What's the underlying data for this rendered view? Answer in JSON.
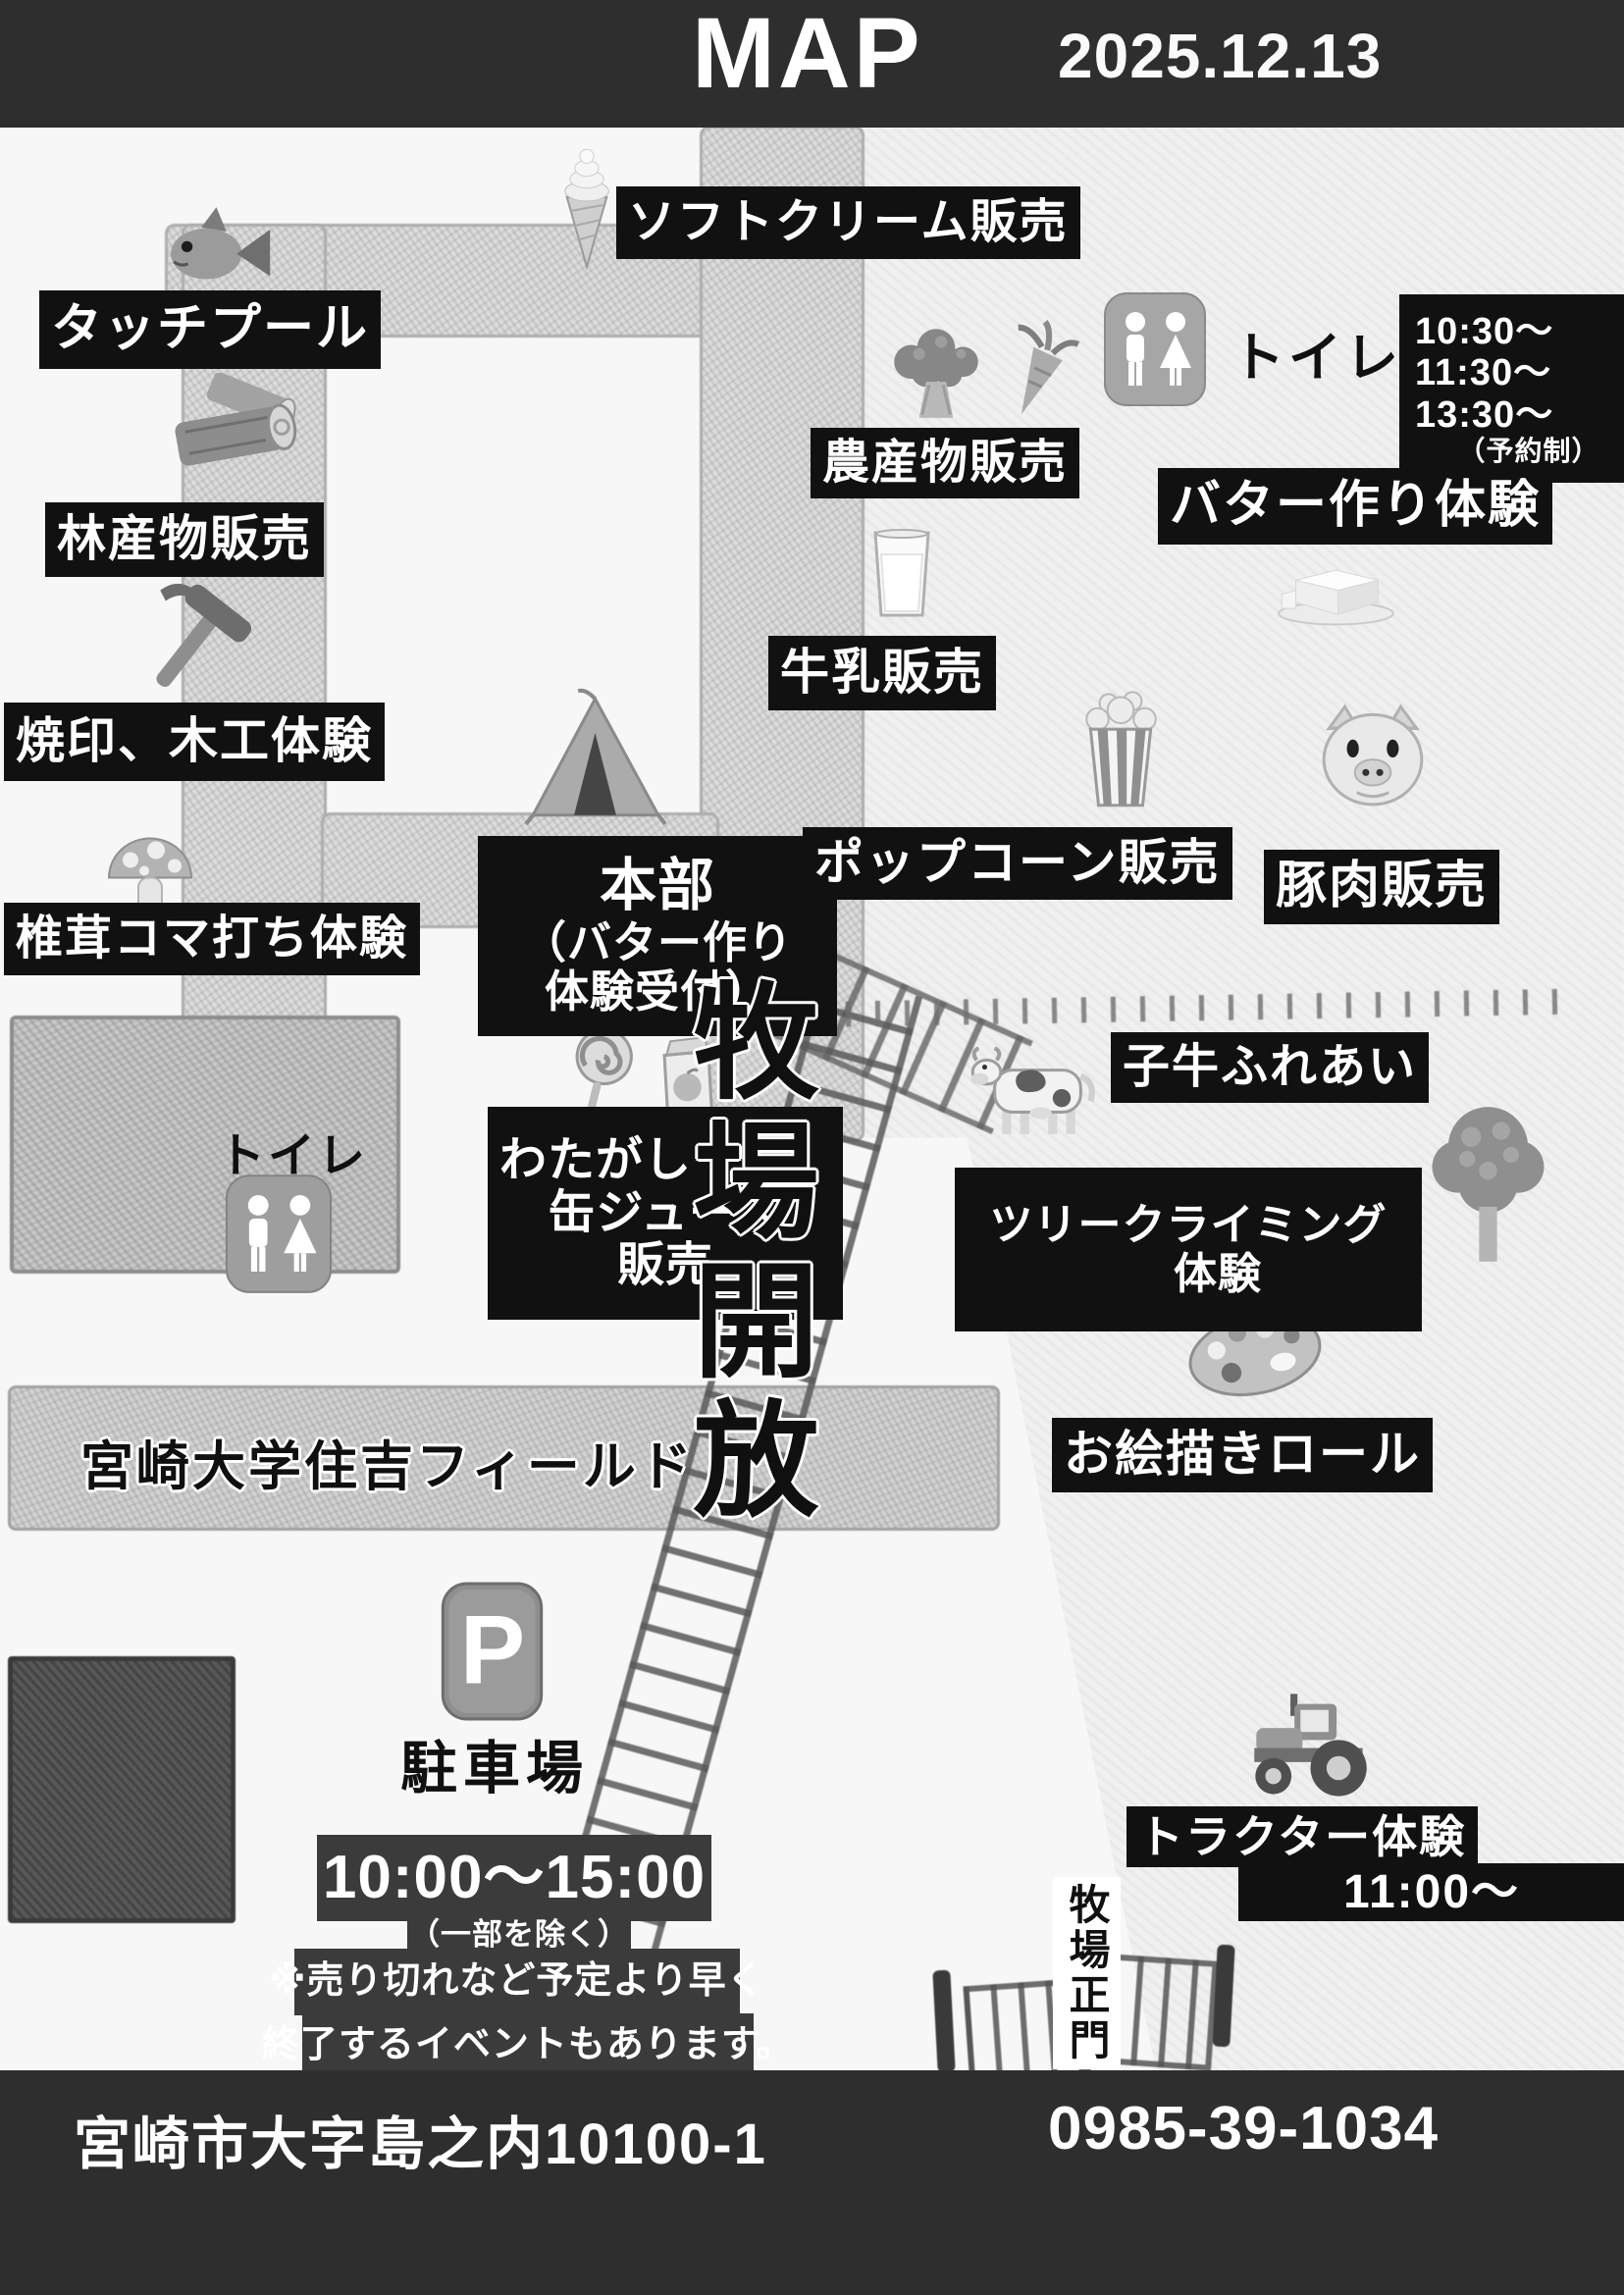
{
  "header": {
    "title": "MAP",
    "date": "2025.12.13"
  },
  "stalls": {
    "soft_cream": "ソフトクリーム販売",
    "touch_pool": "タッチプール",
    "forest_products": "林産物販売",
    "branding_woodwork": "焼印、木工体験",
    "shiitake": "椎茸コマ打ち体験",
    "agri_products": "農産物販売",
    "milk_sale": "牛乳販売",
    "popcorn": "ポップコーン販売",
    "pork": "豚肉販売",
    "cotton_candy": {
      "line1": "わたがし",
      "line2": "缶ジュース",
      "line3": "販売"
    },
    "hq": {
      "line1": "本部",
      "line2": "（バター作り",
      "line3": "体験受付）"
    },
    "butter": {
      "label": "バター作り体験",
      "times": [
        "10:30〜",
        "11:30〜",
        "13:30〜"
      ],
      "note": "（予約制）"
    },
    "calf": "子牛ふれあい",
    "tree_climbing": {
      "line1": "ツリークライミング",
      "line2": "体験"
    },
    "paint_roll": "お絵描きロール",
    "tractor": {
      "label": "トラクター体験",
      "time": "11:00〜"
    }
  },
  "places": {
    "toilet_upper": "トイレ",
    "toilet_lower": "トイレ",
    "pasture_open": "牧場開放",
    "field": "宮崎大学住吉フィールド",
    "parking": "駐車場",
    "main_gate": "牧場正門"
  },
  "schedule": {
    "hours": "10:00〜15:00",
    "hours_note": "（一部を除く）",
    "notice_line1": "※売り切れなど予定より早く",
    "notice_line2": "終了するイベントもあります。"
  },
  "footer": {
    "address": "宮崎市大字島之内10100-1",
    "phone": "0985-39-1034"
  },
  "colors": {
    "header_bar": "#2e2e2e",
    "label_box": "#111111",
    "notice_box": "#3b3b3b",
    "footer_bar": "#2e2e2e",
    "road": "#dcdcdc",
    "pasture": "#f0f0f0"
  }
}
